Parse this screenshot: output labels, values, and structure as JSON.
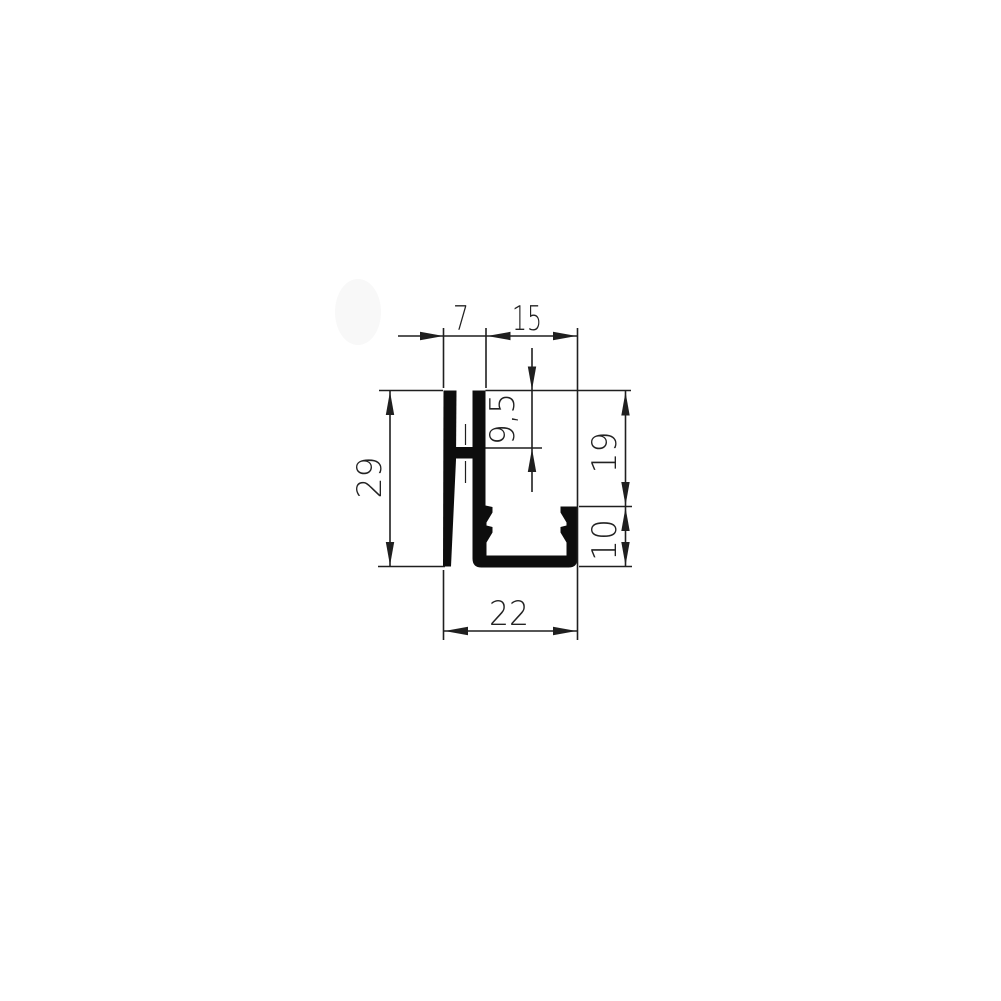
{
  "drawing": {
    "kind": "profile cross-section technical drawing",
    "colors": {
      "line": "#1f1f1f",
      "profile_fill": "#0d0d0d",
      "background": "#ffffff",
      "watermark_smudge": "#f8f8f8"
    },
    "dimensions": {
      "top_left": {
        "label": "7",
        "value": 7,
        "orientation": "horizontal"
      },
      "top_right": {
        "label": "15",
        "value": 15,
        "orientation": "horizontal"
      },
      "center_vertical": {
        "label": "9,5",
        "value": 9.5,
        "orientation": "vertical"
      },
      "left_side": {
        "label": "29",
        "value": 29,
        "orientation": "vertical"
      },
      "right_upper": {
        "label": "19",
        "value": 19,
        "orientation": "vertical"
      },
      "right_lower": {
        "label": "10",
        "value": 10,
        "orientation": "vertical"
      },
      "bottom": {
        "label": "22",
        "value": 22,
        "orientation": "horizontal"
      }
    }
  }
}
